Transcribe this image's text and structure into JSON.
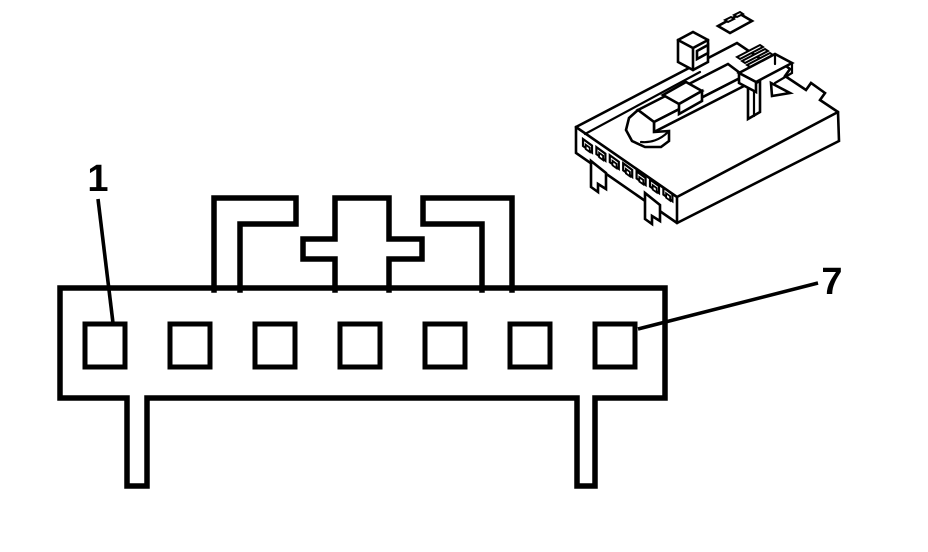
{
  "figure": {
    "kind": "connector-pinout-diagram",
    "background_color": "#ffffff",
    "line_color": "#000000",
    "front_view": {
      "terminal_count": 7,
      "first_terminal_label": "1",
      "last_terminal_label": "7"
    },
    "iso_view": {
      "terminal_count": 7
    }
  }
}
